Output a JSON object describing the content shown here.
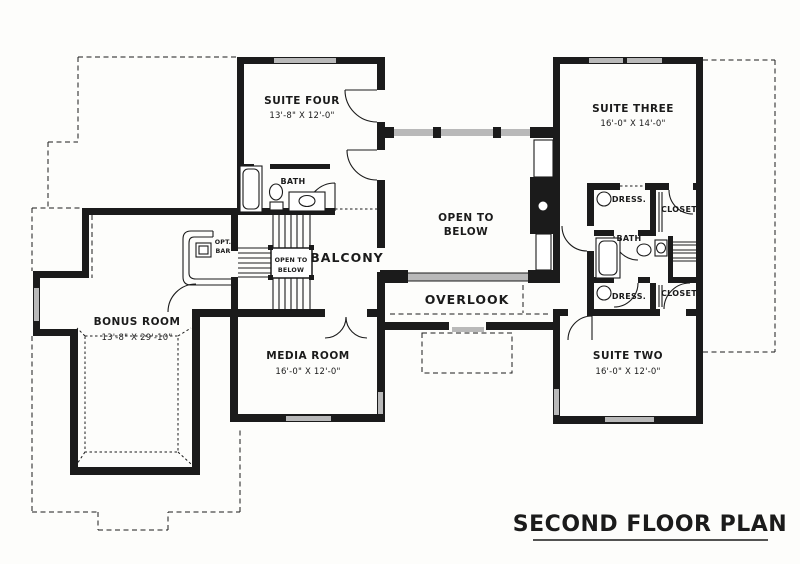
{
  "title": "SECOND FLOOR PLAN",
  "rooms": {
    "suite_four": {
      "name": "SUITE FOUR",
      "dims": "13'-8\" X 12'-0\""
    },
    "suite_three": {
      "name": "SUITE THREE",
      "dims": "16'-0\" X 14'-0\""
    },
    "suite_two": {
      "name": "SUITE TWO",
      "dims": "16'-0\" X 12'-0\""
    },
    "media_room": {
      "name": "MEDIA ROOM",
      "dims": "16'-0\" X 12'-0\""
    },
    "bonus_room": {
      "name": "BONUS ROOM",
      "dims": "13'-8\" X 29'-10\""
    },
    "bath_upper": {
      "name": "BATH"
    },
    "bath_right": {
      "name": "BATH"
    },
    "balcony": {
      "name": "BALCONY"
    },
    "overlook": {
      "name": "OVERLOOK"
    },
    "open_to_below_main": {
      "line1": "OPEN TO",
      "line2": "BELOW"
    },
    "open_to_below_stair": {
      "line1": "OPEN TO",
      "line2": "BELOW"
    },
    "opt_bar": {
      "line1": "OPT.",
      "line2": "BAR"
    },
    "dress_top": {
      "name": "DRESS."
    },
    "dress_bottom": {
      "name": "DRESS."
    },
    "closet_top": {
      "name": "CLOSET"
    },
    "closet_bottom": {
      "name": "CLOSET"
    }
  },
  "colors": {
    "line": "#1b1b1b",
    "window": "#b9b9b9",
    "background": "#fdfdfb"
  }
}
